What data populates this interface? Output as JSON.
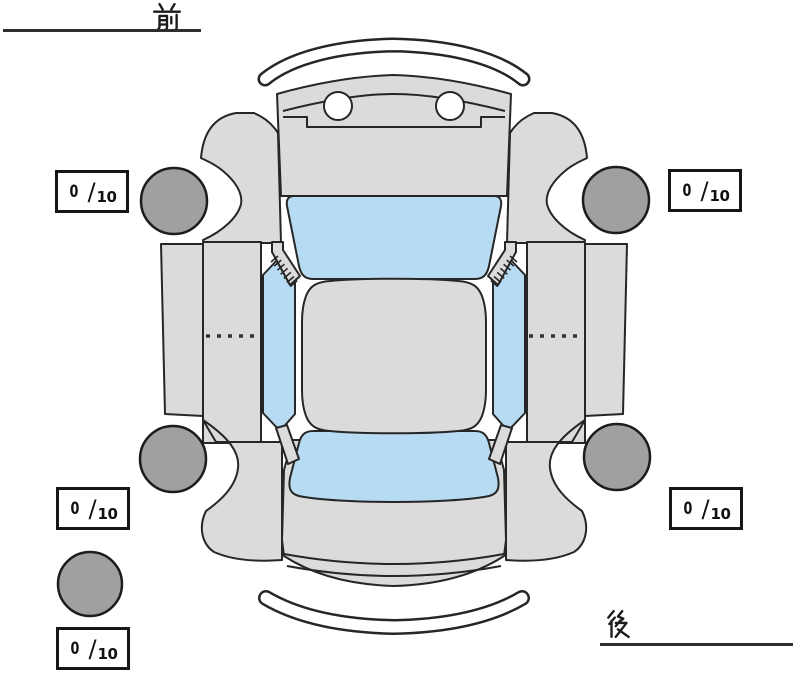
{
  "orientation_labels": {
    "front": "前",
    "rear": "後"
  },
  "tread_depth_boxes": {
    "front_left": {
      "value": "0",
      "separator": "/",
      "max": "10"
    },
    "front_right": {
      "value": "0",
      "separator": "/",
      "max": "10"
    },
    "rear_left": {
      "value": "0",
      "separator": "/",
      "max": "10"
    },
    "rear_right": {
      "value": "0",
      "separator": "/",
      "max": "10"
    },
    "spare": {
      "value": "0",
      "separator": "/",
      "max": "10"
    }
  },
  "colors": {
    "body_panel": "#dbdbdb",
    "glass": "#b6dbf2",
    "tire": "#a0a0a0",
    "outline": "#262626",
    "label": "#1c1c1c",
    "background": "#ffffff"
  }
}
